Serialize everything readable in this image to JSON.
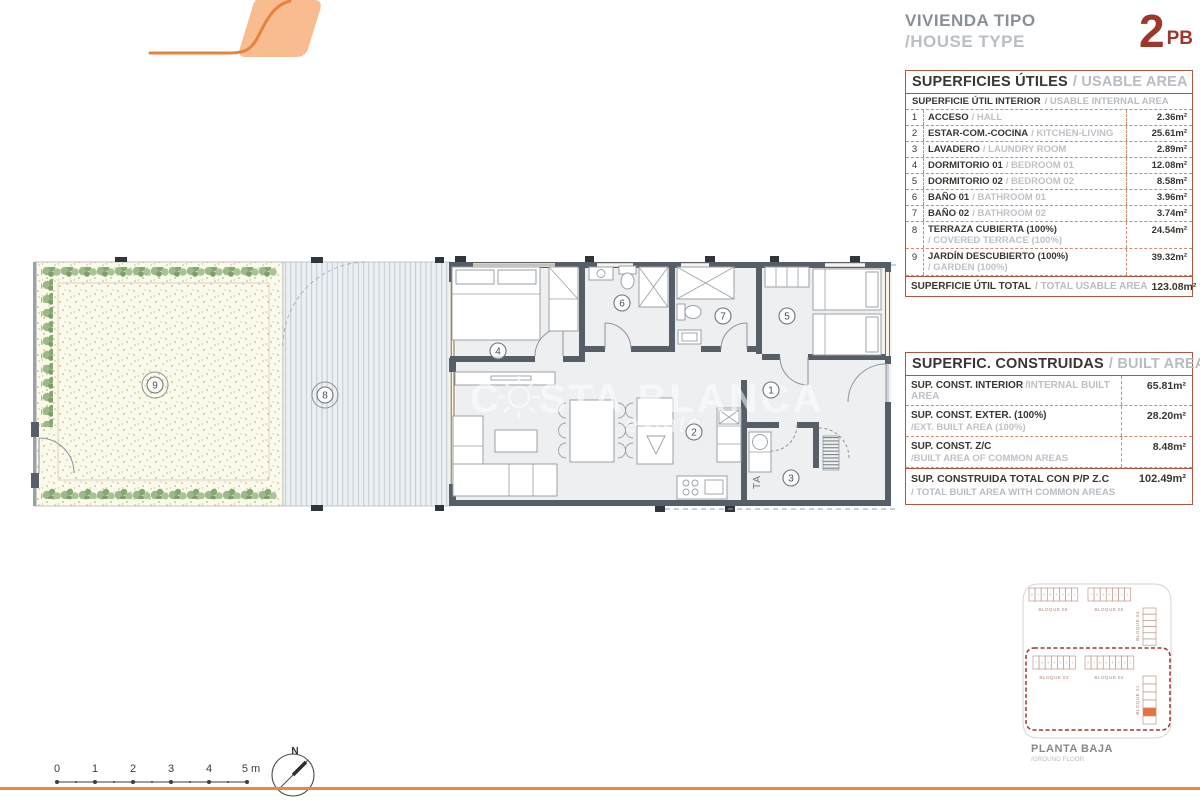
{
  "header": {
    "title_es": "VIVIENDA TIPO",
    "title_en": "/HOUSE TYPE",
    "type_number": "2",
    "type_code": "PB"
  },
  "usable_table": {
    "title_es": "SUPERFICIES ÚTILES",
    "title_en": "/ USABLE AREA",
    "subtitle_es": "SUPERFICIE ÚTIL INTERIOR",
    "subtitle_en": "/ USABLE INTERNAL AREA",
    "rows": [
      {
        "num": "1",
        "es": "ACCESO",
        "en": "/ HALL",
        "value": "2.36m²"
      },
      {
        "num": "2",
        "es": "ESTAR-COM.-COCINA",
        "en": "/ KITCHEN-LIVING",
        "value": "25.61m²"
      },
      {
        "num": "3",
        "es": "LAVADERO",
        "en": "/ LAUNDRY ROOM",
        "value": "2.89m²"
      },
      {
        "num": "4",
        "es": "DORMITORIO 01",
        "en": "/ BEDROOM 01",
        "value": "12.08m²"
      },
      {
        "num": "5",
        "es": "DORMITORIO 02",
        "en": "/ BEDROOM 02",
        "value": "8.58m²"
      },
      {
        "num": "6",
        "es": "BAÑO 01",
        "en": "/ BATHROOM 01",
        "value": "3.96m²"
      },
      {
        "num": "7",
        "es": "BAÑO 02",
        "en": "/ BATHROOM 02",
        "value": "3.74m²"
      },
      {
        "num": "8",
        "es": "TERRAZA CUBIERTA (100%)",
        "en": "/ COVERED TERRACE (100%)",
        "value": "24.54m²"
      },
      {
        "num": "9",
        "es": "JARDÍN DESCUBIERTO (100%)",
        "en": "/ GARDEN (100%)",
        "value": "39.32m²"
      }
    ],
    "total_es": "SUPERFICIE ÚTIL TOTAL",
    "total_en": "/ TOTAL USABLE AREA",
    "total_value": "123.08m²"
  },
  "built_table": {
    "title_es": "SUPERFIC. CONSTRUIDAS",
    "title_en": "/ BUILT AREA",
    "rows": [
      {
        "es": "SUP. CONST. INTERIOR",
        "en": "/INTERNAL BUILT AREA",
        "value": "65.81m²"
      },
      {
        "es": "SUP. CONST. EXTER. (100%)",
        "en": "/EXT. BUILT AREA (100%)",
        "value": "28.20m²"
      },
      {
        "es": "SUP. CONST. Z/C",
        "en": "/BUILT AREA OF COMMON AREAS",
        "value": "8.48m²"
      }
    ],
    "total_es": "SUP. CONSTRUIDA TOTAL CON P/P Z.C",
    "total_en": "/ TOTAL BUILT AREA WITH COMMON AREAS",
    "total_value": "102.49m²"
  },
  "plan": {
    "room_labels": {
      "r1": "1",
      "r2": "2",
      "r3": "3",
      "r4": "4",
      "r5": "5",
      "r6": "6",
      "r7": "7",
      "r8": "8",
      "r9": "9"
    },
    "laundry_text": "TA"
  },
  "watermark": {
    "part1": "C",
    "part2": "STA BLANCA",
    "line2": "estate"
  },
  "site_plan": {
    "blocks": [
      {
        "name": "BLOQUE 06",
        "units": 8
      },
      {
        "name": "BLOQUE 05",
        "units": 7
      },
      {
        "name": "BLOQUE 04",
        "units": 6
      },
      {
        "name": "BLOQUE 03",
        "units": 7
      },
      {
        "name": "BLOQUE 02",
        "units": 8
      },
      {
        "name": "BLOQUE 01",
        "units": 6,
        "highlight_index": 4
      }
    ],
    "caption_es": "PLANTA BAJA",
    "caption_en": "/GROUND FLOOR",
    "highlight_color": "#e8713c"
  },
  "scale_bar": {
    "labels": [
      "0",
      "1",
      "2",
      "3",
      "4",
      "5 m"
    ]
  },
  "compass": {
    "label": "N"
  },
  "colors": {
    "accent_orange": "#ef8445",
    "logo_fill": "#f9bb90",
    "brand_red": "#9d372c",
    "table_border": "#ab5742",
    "wall": "#565e68"
  }
}
